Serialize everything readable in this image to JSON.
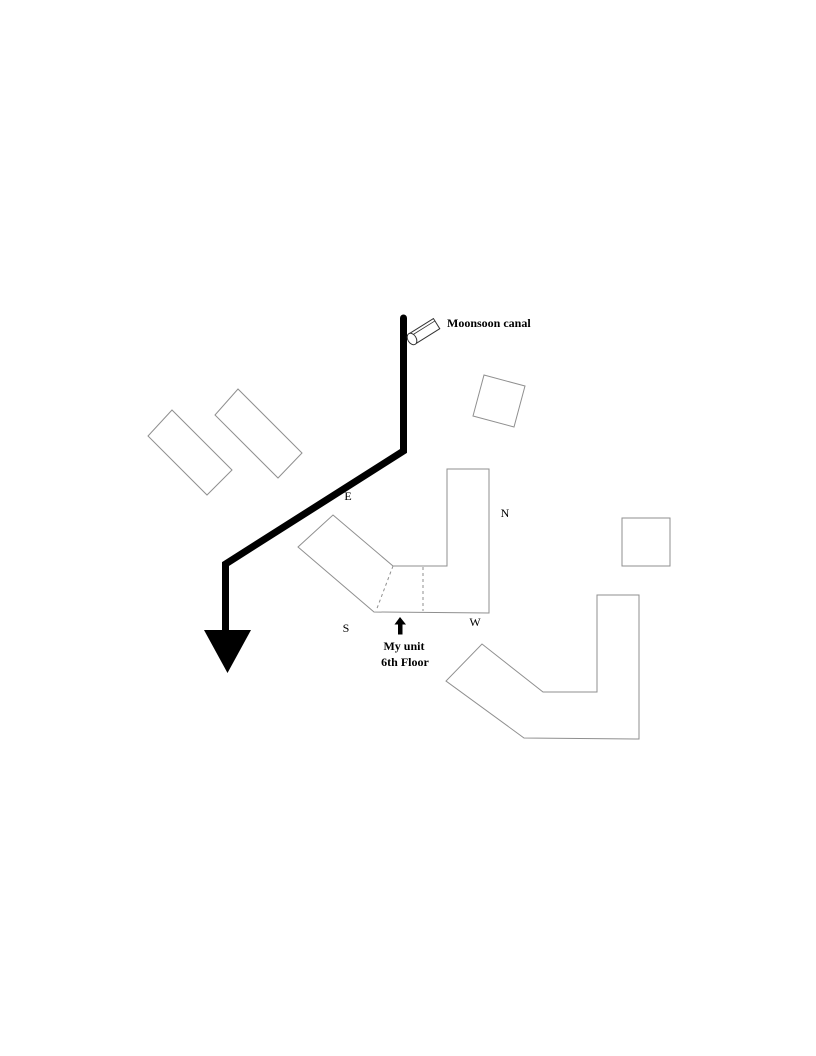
{
  "colors": {
    "canal": "#000000",
    "outline": "#8f8f8f",
    "dashed": "#8f8f8f",
    "icon_outline": "#333333",
    "text": "#000000",
    "building_fill": "#ffffff"
  },
  "drawing": {
    "canal_label": "Moonsoon canal",
    "compass": {
      "north": "N",
      "south": "S",
      "east": "E",
      "west": "W"
    },
    "unit_label_line1": "My unit",
    "unit_label_line2": "6th Floor"
  },
  "icons": {
    "canal_cylinder": "cylinder-3d-icon",
    "canal_flow": "down-arrowhead-icon",
    "unit_pointer": "up-arrow-icon"
  }
}
